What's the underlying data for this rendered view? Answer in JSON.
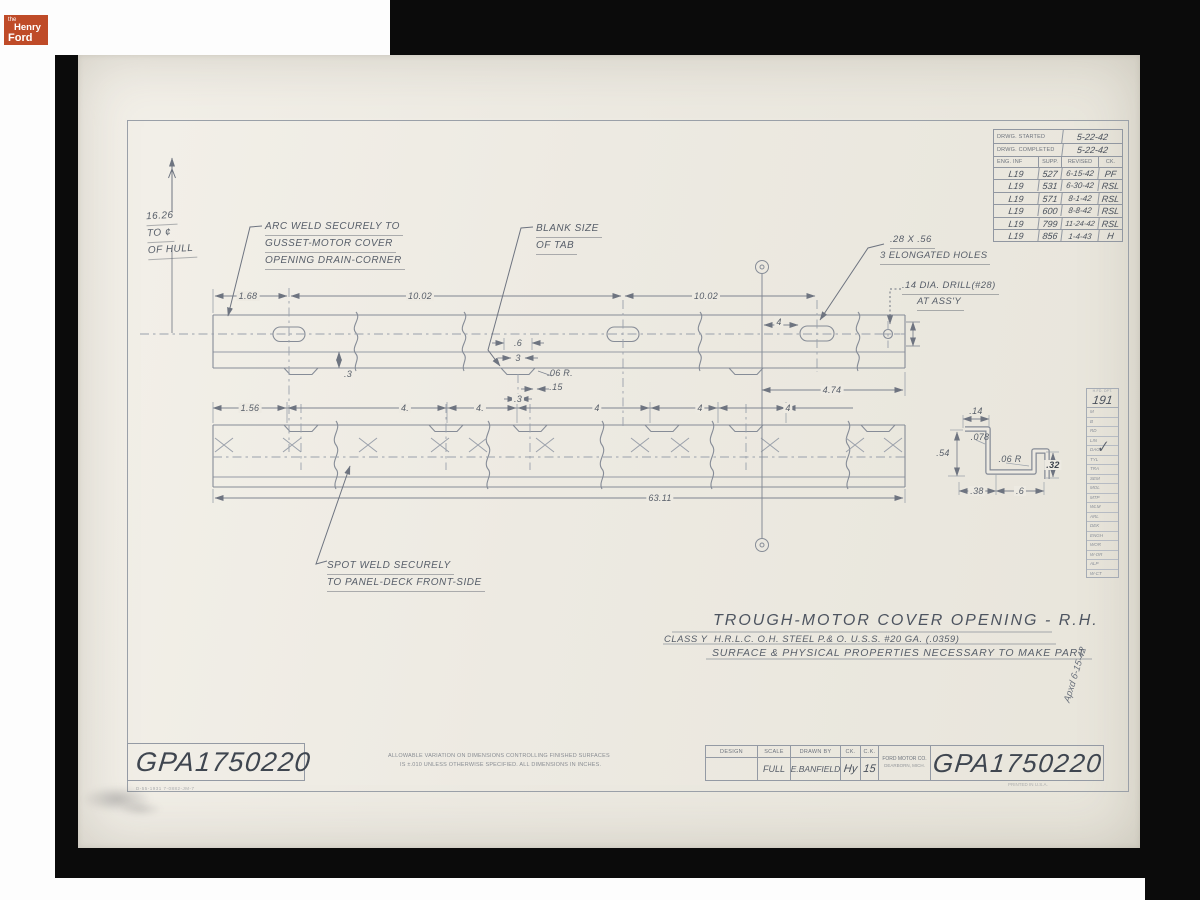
{
  "branding": {
    "the": "the",
    "henry": "Henry",
    "ford": "Ford"
  },
  "revision_table": {
    "started_label": "DRWG. STARTED",
    "started_value": "5-22-42",
    "completed_label": "DRWG. COMPLETED",
    "completed_value": "5-22-42",
    "col_eng": "ENG. INF",
    "col_supp": "SUPP.",
    "col_revised": "REVISED",
    "col_ck": "CK.",
    "rows": [
      {
        "eng": "L19",
        "supp": "527",
        "rev": "6-15-42",
        "ck": "PF"
      },
      {
        "eng": "L19",
        "supp": "531",
        "rev": "6-30-42",
        "ck": "RSL"
      },
      {
        "eng": "L19",
        "supp": "571",
        "rev": "8-1-42",
        "ck": "RSL"
      },
      {
        "eng": "L19",
        "supp": "600",
        "rev": "8-8-42",
        "ck": "RSL"
      },
      {
        "eng": "L19",
        "supp": "799",
        "rev": "11-24-42",
        "ck": "RSL"
      },
      {
        "eng": "L19",
        "supp": "856",
        "rev": "1-4-43",
        "ck": "H"
      }
    ]
  },
  "dept_table": {
    "header": "H.FD. DPT.",
    "number": "191",
    "rows": [
      "M",
      "B",
      "RD",
      "LIN",
      "DAG",
      "TYL",
      "TRA",
      "SEM",
      "MOL",
      "MTP",
      "WLM",
      "ARL",
      "DEK",
      "ENGH",
      "WOR",
      "W-OR",
      "ALP",
      "W-CT"
    ]
  },
  "annotations": {
    "hull1": "16.26",
    "hull2": "TO ¢",
    "hull3": "OF HULL",
    "arc1": "ARC WELD SECURELY TO",
    "arc2": "GUSSET-MOTOR COVER",
    "arc3": "OPENING DRAIN-CORNER",
    "blank1": "BLANK SIZE",
    "blank2": "OF TAB",
    "holes1": ".28 X .56",
    "holes2": "3 ELONGATED HOLES",
    "drill1": ".14 DIA. DRILL(#28)",
    "drill2": "AT ASS'Y",
    "spot1": "SPOT WELD SECURELY",
    "spot2": "TO PANEL-DECK FRONT-SIDE"
  },
  "dims": {
    "d168": "1.68",
    "d1002a": "10.02",
    "d1002b": "10.02",
    "d4s": "4",
    "d3a": ".3",
    "d6": ".6",
    "d3b": "3",
    "d06r": ".06 R.",
    "d15": ".15",
    "d3c": ".3",
    "d474": "4.74",
    "d156": "1.56",
    "d4a": "4.",
    "d4b": "4.",
    "d4c": "4",
    "d4d": "4",
    "d4e": "4",
    "d6311": "63.11"
  },
  "section": {
    "d14": ".14",
    "d078": ".078",
    "d54": ".54",
    "d06r": ".06 R",
    "d32": ".32",
    "d38": ".38",
    "d6": ".6"
  },
  "title": {
    "main": "TROUGH-MOTOR COVER OPENING - R.H.",
    "class_label": "CLASS Y",
    "class_spec": "H.R.L.C. O.H. STEEL  P.& O.  U.S.S. #20 GA. (.0359)",
    "surface": "SURFACE & PHYSICAL PROPERTIES NECESSARY TO MAKE PART"
  },
  "title_block": {
    "design": "DESIGN",
    "scale": "SCALE",
    "drawn": "DRAWN BY",
    "ck": "CK.",
    "ck2": "C.K.",
    "company": "FORD MOTOR CO.",
    "company_city": "DEARBORN, MICH.",
    "scale_value": "FULL",
    "drawn_value": "E.BANFIELD",
    "ck_value": "Hy",
    "ck2_value": "15",
    "number": "GPA1750220"
  },
  "footer": {
    "number_left": "GPA1750220",
    "small_left": "D-55-1931  7-0882-JM-7",
    "allow1": "ALLOWABLE VARIATION ON DIMENSIONS CONTROLLING FINISHED SURFACES",
    "allow2": "IS ±.010 UNLESS OTHERWISE SPECIFIED.   ALL DIMENSIONS IN INCHES.",
    "printed": "PRINTED IN U.S.A.",
    "approved": "Apxd 6-15-42"
  }
}
